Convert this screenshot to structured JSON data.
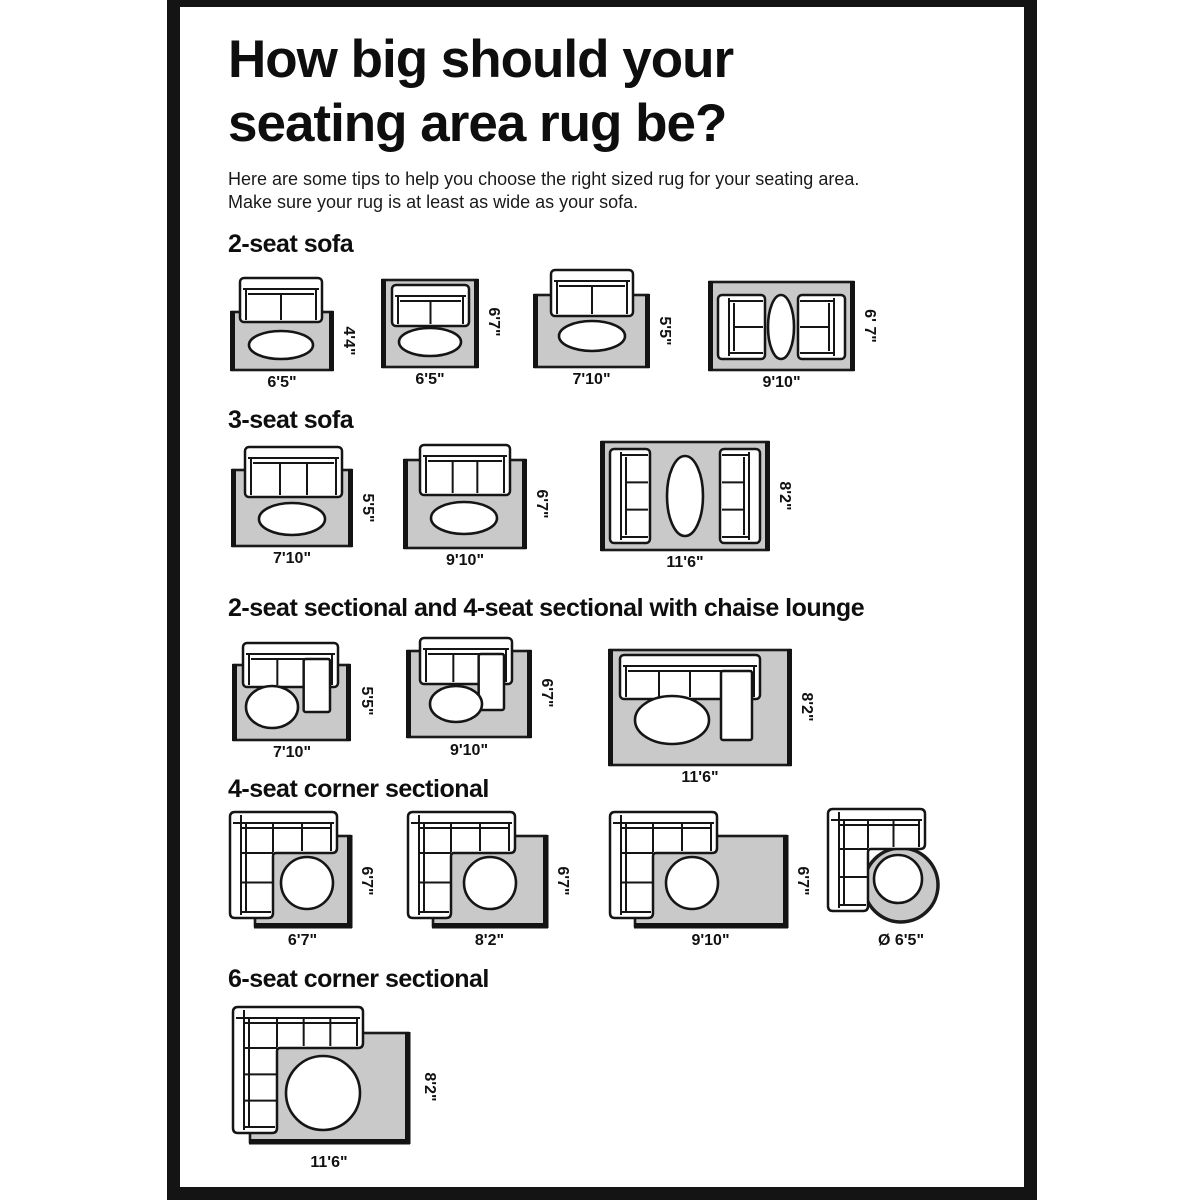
{
  "page": {
    "title_line1": "How big should your",
    "title_line2": "seating area rug be?",
    "subtitle_line1": "Here are some tips to help you choose the right sized rug for your seating area.",
    "subtitle_line2": "Make sure your rug is at least as wide as your sofa.",
    "colors": {
      "background": "#ffffff",
      "poster_border": "#141414",
      "rug_fill": "#c9c9c9",
      "rug_edge": "#1b1b1b",
      "line": "#151515",
      "furniture_fill": "#ffffff"
    }
  },
  "sections": [
    {
      "heading": "2-seat sofa",
      "diagrams": [
        {
          "width_label": "6'5\"",
          "height_label": "4'4\"",
          "width_ft": 6.42,
          "height_ft": 4.33,
          "furniture": "2-seat sofa overhanging rug top edge, oval coffee table"
        },
        {
          "width_label": "6'5\"",
          "height_label": "6'7\"",
          "width_ft": 6.42,
          "height_ft": 6.58,
          "furniture": "2-seat sofa fully on rug, oval coffee table"
        },
        {
          "width_label": "7'10\"",
          "height_label": "5'5\"",
          "width_ft": 7.83,
          "height_ft": 5.42,
          "furniture": "2-seat sofa overhanging rug top edge, oval coffee table"
        },
        {
          "width_label": "9'10\"",
          "height_label": "6' 7\"",
          "width_ft": 9.83,
          "height_ft": 6.58,
          "furniture": "two 2-seat sofas facing each other, oval coffee table between"
        }
      ]
    },
    {
      "heading": "3-seat sofa",
      "diagrams": [
        {
          "width_label": "7'10\"",
          "height_label": "5'5\"",
          "width_ft": 7.83,
          "height_ft": 5.42,
          "furniture": "3-seat sofa overhanging rug top edge, oval coffee table"
        },
        {
          "width_label": "9'10\"",
          "height_label": "6'7\"",
          "width_ft": 9.83,
          "height_ft": 6.58,
          "furniture": "3-seat sofa overhanging rug top edge, oval coffee table"
        },
        {
          "width_label": "11'6\"",
          "height_label": "8'2\"",
          "width_ft": 11.5,
          "height_ft": 8.17,
          "furniture": "two 3-seat sofas facing each other, oval coffee table between"
        }
      ]
    },
    {
      "heading": "2-seat sectional and 4-seat sectional with chaise lounge",
      "diagrams": [
        {
          "width_label": "7'10\"",
          "height_label": "5'5\"",
          "width_ft": 7.83,
          "height_ft": 5.42,
          "furniture": "2-seat sectional with chaise lounge, round coffee table"
        },
        {
          "width_label": "9'10\"",
          "height_label": "6'7\"",
          "width_ft": 9.83,
          "height_ft": 6.58,
          "furniture": "sectional with chaise lounge, round coffee table"
        },
        {
          "width_label": "11'6\"",
          "height_label": "8'2\"",
          "width_ft": 11.5,
          "height_ft": 8.17,
          "furniture": "4-seat sectional with chaise lounge, oval coffee table"
        }
      ]
    },
    {
      "heading": "4-seat corner sectional",
      "diagrams": [
        {
          "width_label": "6'7\"",
          "height_label": "6'7\"",
          "width_ft": 6.58,
          "height_ft": 6.58,
          "furniture": "4-seat corner sectional, round coffee table"
        },
        {
          "width_label": "8'2\"",
          "height_label": "6'7\"",
          "width_ft": 8.17,
          "height_ft": 6.58,
          "furniture": "4-seat corner sectional, round coffee table"
        },
        {
          "width_label": "9'10\"",
          "height_label": "6'7\"",
          "width_ft": 9.83,
          "height_ft": 6.58,
          "furniture": "4-seat corner sectional, round coffee table"
        },
        {
          "width_label": "Ø 6'5\"",
          "height_label": "",
          "diameter_ft": 6.42,
          "furniture": "4-seat corner sectional on round rug, round coffee table"
        }
      ]
    },
    {
      "heading": "6-seat corner sectional",
      "diagrams": [
        {
          "width_label": "11'6\"",
          "height_label": "8'2\"",
          "width_ft": 11.5,
          "height_ft": 8.17,
          "furniture": "6-seat corner sectional, round coffee table"
        }
      ]
    }
  ]
}
